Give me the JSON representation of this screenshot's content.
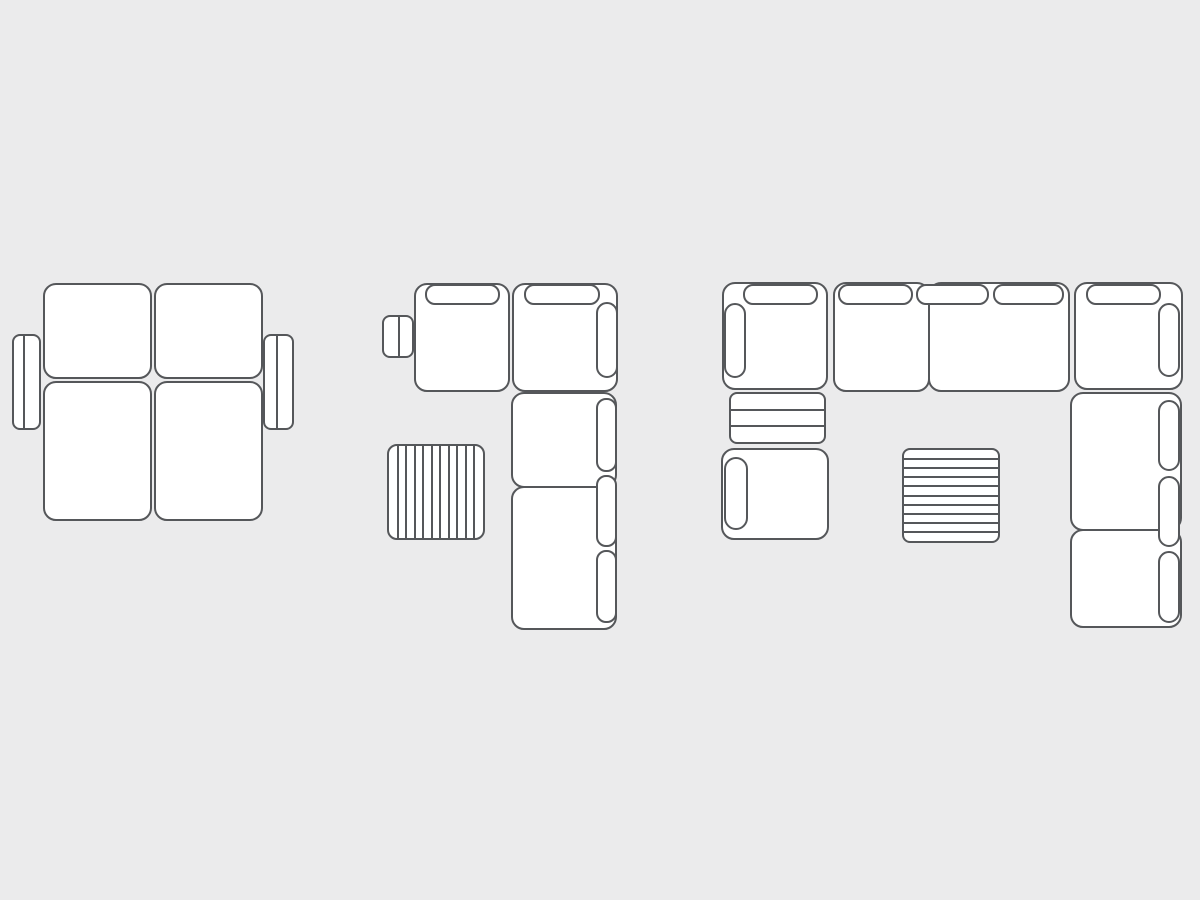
{
  "canvas": {
    "width": 1200,
    "height": 900,
    "background_color": "#ebebec",
    "stroke_color": "#55575a",
    "fill_color": "#ffffff",
    "stroke_width": 2
  },
  "diagram": {
    "type": "furniture-top-view-configurations",
    "layouts": [
      {
        "name": "two-seater-sofa-with-side-armrests",
        "parts": [
          {
            "name": "left-armrest",
            "type": "armrest",
            "x": 12,
            "y": 334,
            "w": 29,
            "h": 96,
            "r": 8,
            "divider": 0.4
          },
          {
            "name": "right-armrest",
            "type": "armrest",
            "x": 263,
            "y": 334,
            "w": 31,
            "h": 96,
            "r": 8,
            "divider": 0.44
          },
          {
            "name": "seat-cushion-top-left",
            "type": "seat",
            "x": 43,
            "y": 283,
            "w": 109,
            "h": 96,
            "r": 13
          },
          {
            "name": "seat-cushion-top-right",
            "type": "seat",
            "x": 154,
            "y": 283,
            "w": 109,
            "h": 96,
            "r": 13
          },
          {
            "name": "chaise-cushion-bottom-left",
            "type": "seat",
            "x": 43,
            "y": 381,
            "w": 109,
            "h": 140,
            "r": 13
          },
          {
            "name": "chaise-cushion-bottom-right",
            "type": "seat",
            "x": 154,
            "y": 381,
            "w": 109,
            "h": 140,
            "r": 13
          }
        ]
      },
      {
        "name": "l-shaped-sectional-with-ottoman",
        "parts": [
          {
            "name": "left-armrest",
            "type": "armrest",
            "x": 382,
            "y": 315,
            "w": 32,
            "h": 43,
            "r": 8,
            "divider": 0.53
          },
          {
            "name": "seat-module-top-left",
            "type": "seat",
            "x": 414,
            "y": 283,
            "w": 96,
            "h": 109,
            "r": 13
          },
          {
            "name": "corner-seat-module",
            "type": "seat",
            "x": 512,
            "y": 283,
            "w": 106,
            "h": 109,
            "r": 13
          },
          {
            "name": "seat-module-right-upper",
            "type": "seat",
            "x": 511,
            "y": 392,
            "w": 106,
            "h": 96,
            "r": 13
          },
          {
            "name": "chaise-module-right-lower",
            "type": "seat",
            "x": 511,
            "y": 486,
            "w": 106,
            "h": 144,
            "r": 13
          },
          {
            "name": "back-cushion",
            "type": "pill",
            "x": 425,
            "y": 284,
            "w": 75,
            "h": 21,
            "r": 10
          },
          {
            "name": "back-cushion",
            "type": "pill",
            "x": 524,
            "y": 284,
            "w": 76,
            "h": 21,
            "r": 10
          },
          {
            "name": "side-back-cushion",
            "type": "pill",
            "x": 596,
            "y": 302,
            "w": 22,
            "h": 76,
            "r": 11
          },
          {
            "name": "side-back-cushion",
            "type": "pill",
            "x": 596,
            "y": 398,
            "w": 21,
            "h": 74,
            "r": 10
          },
          {
            "name": "side-back-cushion",
            "type": "pill",
            "x": 596,
            "y": 475,
            "w": 21,
            "h": 72,
            "r": 10
          },
          {
            "name": "side-back-cushion",
            "type": "pill",
            "x": 596,
            "y": 550,
            "w": 21,
            "h": 73,
            "r": 10
          },
          {
            "name": "striped-ottoman",
            "type": "striped",
            "x": 387,
            "y": 444,
            "w": 98,
            "h": 96,
            "r": 10,
            "lines": 10,
            "dir": "v"
          }
        ]
      },
      {
        "name": "u-shaped-sectional-with-ottoman",
        "parts": [
          {
            "name": "corner-seat-module-top-left",
            "type": "seat",
            "x": 722,
            "y": 282,
            "w": 106,
            "h": 108,
            "r": 13
          },
          {
            "name": "seat-module-top",
            "type": "seat",
            "x": 833,
            "y": 282,
            "w": 97,
            "h": 110,
            "r": 13
          },
          {
            "name": "wide-seat-module-top",
            "type": "seat",
            "x": 928,
            "y": 282,
            "w": 142,
            "h": 110,
            "r": 13
          },
          {
            "name": "corner-seat-module-top-right",
            "type": "seat",
            "x": 1074,
            "y": 282,
            "w": 109,
            "h": 108,
            "r": 13
          },
          {
            "name": "back-cushion",
            "type": "pill",
            "x": 743,
            "y": 284,
            "w": 75,
            "h": 21,
            "r": 10
          },
          {
            "name": "side-back-cushion",
            "type": "pill",
            "x": 724,
            "y": 303,
            "w": 22,
            "h": 75,
            "r": 11
          },
          {
            "name": "back-cushion",
            "type": "pill",
            "x": 838,
            "y": 284,
            "w": 75,
            "h": 21,
            "r": 10
          },
          {
            "name": "back-cushion",
            "type": "pill",
            "x": 916,
            "y": 284,
            "w": 73,
            "h": 21,
            "r": 10
          },
          {
            "name": "back-cushion",
            "type": "pill",
            "x": 993,
            "y": 284,
            "w": 71,
            "h": 21,
            "r": 10
          },
          {
            "name": "back-cushion",
            "type": "pill",
            "x": 1086,
            "y": 284,
            "w": 75,
            "h": 21,
            "r": 10
          },
          {
            "name": "side-back-cushion",
            "type": "pill",
            "x": 1158,
            "y": 303,
            "w": 22,
            "h": 74,
            "r": 11
          },
          {
            "name": "slatted-shelf-module",
            "type": "striped",
            "x": 729,
            "y": 392,
            "w": 97,
            "h": 52,
            "r": 8,
            "lines": 2,
            "dir": "h"
          },
          {
            "name": "seat-module-bottom-left",
            "type": "seat",
            "x": 721,
            "y": 448,
            "w": 108,
            "h": 92,
            "r": 13
          },
          {
            "name": "side-back-cushion",
            "type": "pill",
            "x": 724,
            "y": 457,
            "w": 24,
            "h": 73,
            "r": 12
          },
          {
            "name": "seat-module-right-upper",
            "type": "seat",
            "x": 1070,
            "y": 392,
            "w": 112,
            "h": 139,
            "r": 13
          },
          {
            "name": "seat-module-right-lower",
            "type": "seat",
            "x": 1070,
            "y": 529,
            "w": 112,
            "h": 99,
            "r": 13
          },
          {
            "name": "side-back-cushion",
            "type": "pill",
            "x": 1158,
            "y": 400,
            "w": 22,
            "h": 71,
            "r": 11
          },
          {
            "name": "side-back-cushion",
            "type": "pill",
            "x": 1158,
            "y": 476,
            "w": 22,
            "h": 71,
            "r": 11
          },
          {
            "name": "side-back-cushion",
            "type": "pill",
            "x": 1158,
            "y": 551,
            "w": 22,
            "h": 72,
            "r": 11
          },
          {
            "name": "striped-ottoman",
            "type": "striped",
            "x": 902,
            "y": 448,
            "w": 98,
            "h": 95,
            "r": 8,
            "lines": 9,
            "dir": "h"
          }
        ]
      }
    ]
  }
}
